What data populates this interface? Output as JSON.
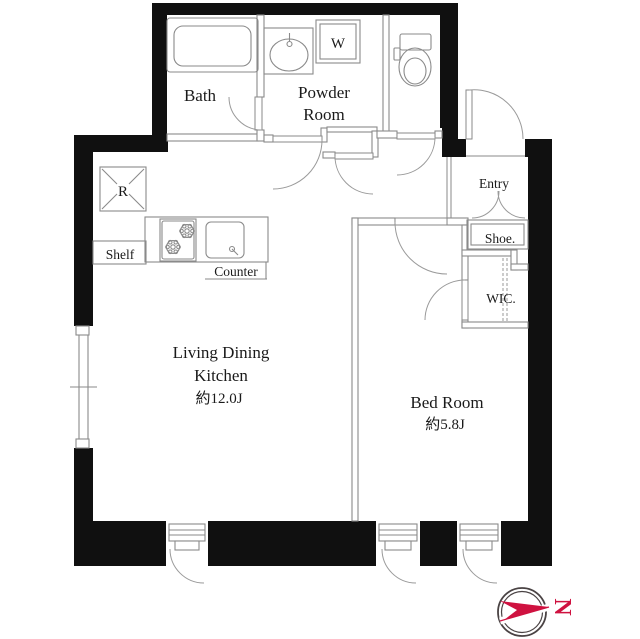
{
  "title": "Apartment floor plan (1LDK)",
  "rooms": {
    "bath": {
      "label": "Bath"
    },
    "powder_room": {
      "label_line1": "Powder",
      "label_line2": "Room"
    },
    "entry": {
      "label": "Entry"
    },
    "shoe_storage": {
      "label": "Shoe."
    },
    "wic": {
      "label": "WIC."
    },
    "ldk": {
      "label_line1": "Living Dining",
      "label_line2": "Kitchen",
      "area": "約12.0J"
    },
    "bedroom": {
      "label": "Bed Room",
      "area": "約5.8J"
    }
  },
  "fixtures": {
    "washer": "W",
    "refrigerator": "R",
    "shelf": "Shelf",
    "counter": "Counter"
  },
  "compass": {
    "letter": "N",
    "arrow_color": "#cf1240",
    "ring_color": "#4a4344"
  },
  "colors": {
    "wall": "#101010",
    "thin_line": "#8a8a8a",
    "text": "#1a1a1a",
    "background": "#ffffff"
  }
}
